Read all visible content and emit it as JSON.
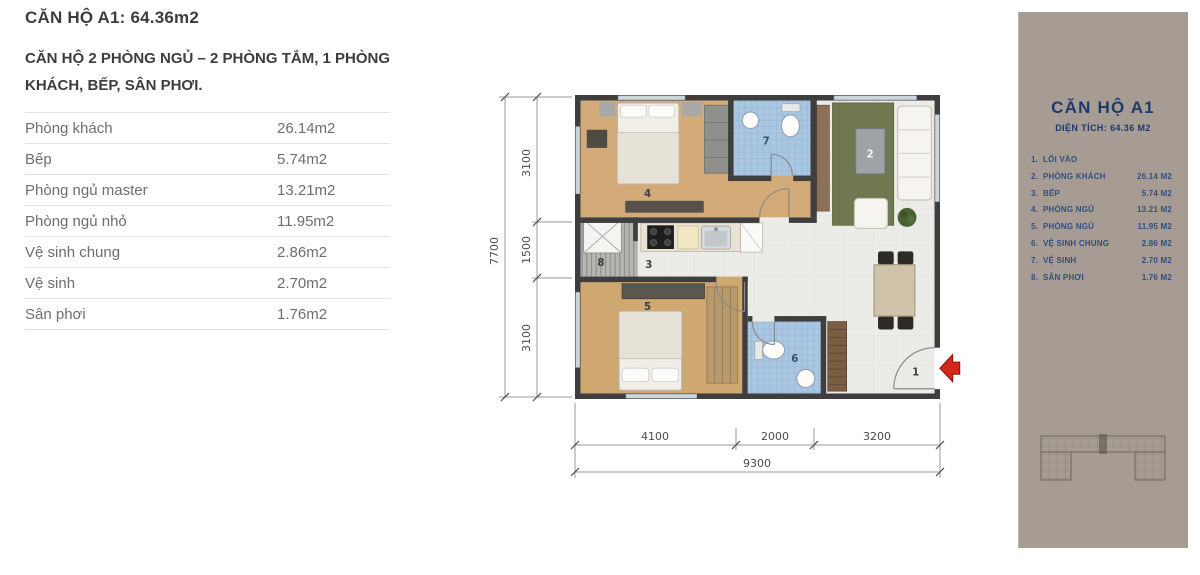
{
  "page": {
    "title": "CĂN HỘ A1:  64.36m2",
    "subtitle": "CĂN HỘ 2 PHÒNG NGỦ – 2 PHÒNG TẮM, 1 PHÒNG KHÁCH, BẾP, SÂN PHƠI."
  },
  "area_table": {
    "rows": [
      {
        "label": "Phòng khách",
        "value": "26.14m2"
      },
      {
        "label": "Bếp",
        "value": "5.74m2"
      },
      {
        "label": "Phòng ngủ master",
        "value": "13.21m2"
      },
      {
        "label": "Phòng ngủ nhỏ",
        "value": "11.95m2"
      },
      {
        "label": "Vệ sinh chung",
        "value": "2.86m2"
      },
      {
        "label": "Vệ sinh",
        "value": "2.70m2"
      },
      {
        "label": "Sân phơi",
        "value": "1.76m2"
      }
    ]
  },
  "floor_plan": {
    "room_labels": [
      "1",
      "2",
      "3",
      "4",
      "5",
      "6",
      "7",
      "8"
    ],
    "dimensions": {
      "left_total": "7700",
      "left_segments": [
        "3100",
        "1500",
        "3100"
      ],
      "bottom_segments": [
        "4100",
        "2000",
        "3200"
      ],
      "bottom_total": "9300"
    },
    "colors": {
      "wall": "#3e3e3e",
      "wood_floor": "#d2ab79",
      "bath_tile": "#a9c6e2",
      "rug_green": "#6f7851",
      "entry_arrow_red": "#d3271c"
    }
  },
  "side_panel": {
    "title": "CĂN HỘ A1",
    "subtitle": "DIỆN TÍCH: 64.36 M2",
    "legend": [
      {
        "num": "1.",
        "label": "LỐI VÀO",
        "value": ""
      },
      {
        "num": "2.",
        "label": "PHÒNG KHÁCH",
        "value": "26.14 M2"
      },
      {
        "num": "3.",
        "label": "BẾP",
        "value": "5.74 M2"
      },
      {
        "num": "4.",
        "label": "PHÒNG NGỦ",
        "value": "13.21 M2"
      },
      {
        "num": "5.",
        "label": "PHÒNG NGỦ",
        "value": "11.95 M2"
      },
      {
        "num": "6.",
        "label": "VỆ SINH CHUNG",
        "value": "2.86 M2"
      },
      {
        "num": "7.",
        "label": "VỆ SINH",
        "value": "2.70 M2"
      },
      {
        "num": "8.",
        "label": "SÂN PHƠI",
        "value": "1.76 M2"
      }
    ],
    "colors": {
      "background": "#a69c94",
      "accent": "#1c3a6b"
    }
  }
}
